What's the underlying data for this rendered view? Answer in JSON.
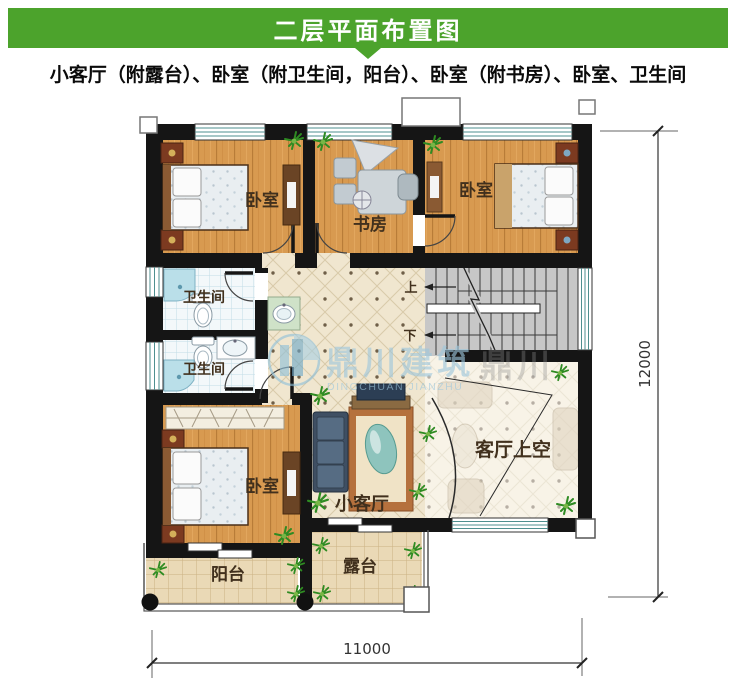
{
  "header": {
    "title": "二层平面布置图"
  },
  "subtitle": "小客厅（附露台）、卧室（附卫生间，阳台）、卧室（附书房）、卧室、卫生间",
  "plan": {
    "labels": {
      "bedroom_tl": "卧室",
      "study": "书房",
      "bedroom_tr": "卧室",
      "bath1": "卫生间",
      "bath2": "卫生间",
      "bedroom_bl": "卧室",
      "small_living": "小客厅",
      "living_void": "客厅上空",
      "balcony": "阳台",
      "terrace": "露台",
      "stairs_up": "上",
      "stairs_down": "下"
    },
    "dimensions": {
      "bottom": "11000",
      "right": "12000"
    }
  },
  "watermark": {
    "name": "鼎川建筑",
    "partial": "鼎川",
    "sub": "DINGCHUAN JIANZHU"
  },
  "colors": {
    "header_green": "#4ca32c",
    "wall_black": "#151515",
    "wood_floor": "#d89a50",
    "hall_tile": "#f0e6cf",
    "bath_tile": "#f3f8fa",
    "terrace_tile": "#ead9b6",
    "watermark_blue": "#9dc7dd"
  }
}
